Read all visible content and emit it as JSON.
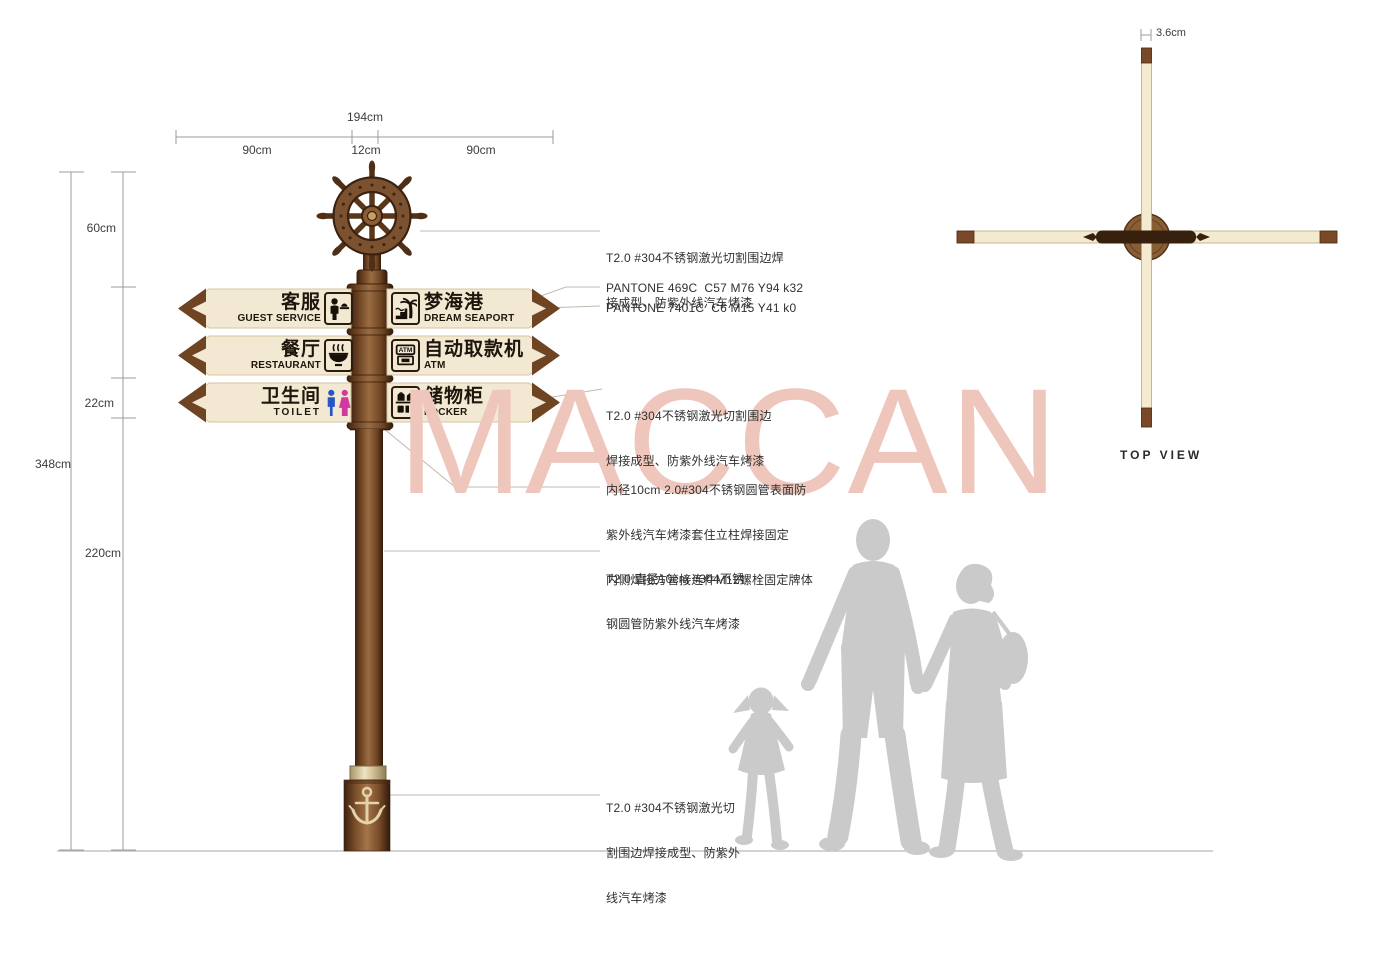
{
  "watermark": "MACCAN",
  "top_view": {
    "label": "TOP VIEW",
    "dim": "3.6cm"
  },
  "dimensions": {
    "overall_width": "194cm",
    "left_arm": "90cm",
    "center_gap": "12cm",
    "right_arm": "90cm",
    "wheel_section": "60cm",
    "panel_height": "22cm",
    "total_height": "348cm",
    "pole_height": "220cm"
  },
  "signs": {
    "left": [
      {
        "zh": "客服",
        "en": "GUEST SERVICE",
        "icon": "guest-service"
      },
      {
        "zh": "餐厅",
        "en": "RESTAURANT",
        "icon": "restaurant"
      },
      {
        "zh": "卫生间",
        "en": "TOILET",
        "icon": "toilet"
      }
    ],
    "right": [
      {
        "zh": "梦海港",
        "en": "DREAM SEAPORT",
        "icon": "seaport"
      },
      {
        "zh": "自动取款机",
        "en": "ATM",
        "icon": "atm"
      },
      {
        "zh": "储物柜",
        "en": "LOCKER",
        "icon": "locker"
      }
    ]
  },
  "annotations": {
    "wheel_note": {
      "line1": "T2.0 #304不锈钢激光切割围边焊",
      "line2": "接成型、防紫外线汽车烤漆"
    },
    "pantone_brown": "PANTONE 469C  C57 M76 Y94 k32",
    "pantone_cream": "PANTONE 7401C  C6 M15 Y41 k0",
    "panel_note": {
      "line1": "T2.0 #304不锈钢激光切割围边",
      "line2": "焊接成型、防紫外线汽车烤漆"
    },
    "sleeve_note": {
      "line1": "内径10cm 2.0#304不锈钢圆管表面防",
      "line2": "紫外线汽车烤漆套住立柱焊接固定",
      "line3": "内侧焊接方管接连件M12螺栓固定牌体"
    },
    "pole_note": {
      "line1": "T2.0 直径10cm #304不锈",
      "line2": "钢圆管防紫外线汽车烤漆"
    },
    "base_note": {
      "line1": "T2.0 #304不锈钢激光切",
      "line2": "割围边焊接成型、防紫外",
      "line3": "线汽车烤漆"
    }
  },
  "colors": {
    "pole_brown": "#6e4423",
    "panel_cream": "#f3e9d3",
    "chevron_brown": "#6e4423",
    "toilet_blue": "#2456c8",
    "toilet_pink": "#d2399e",
    "watermark_pink": "#eec6bc",
    "silhouette_gray": "#cacaca"
  }
}
